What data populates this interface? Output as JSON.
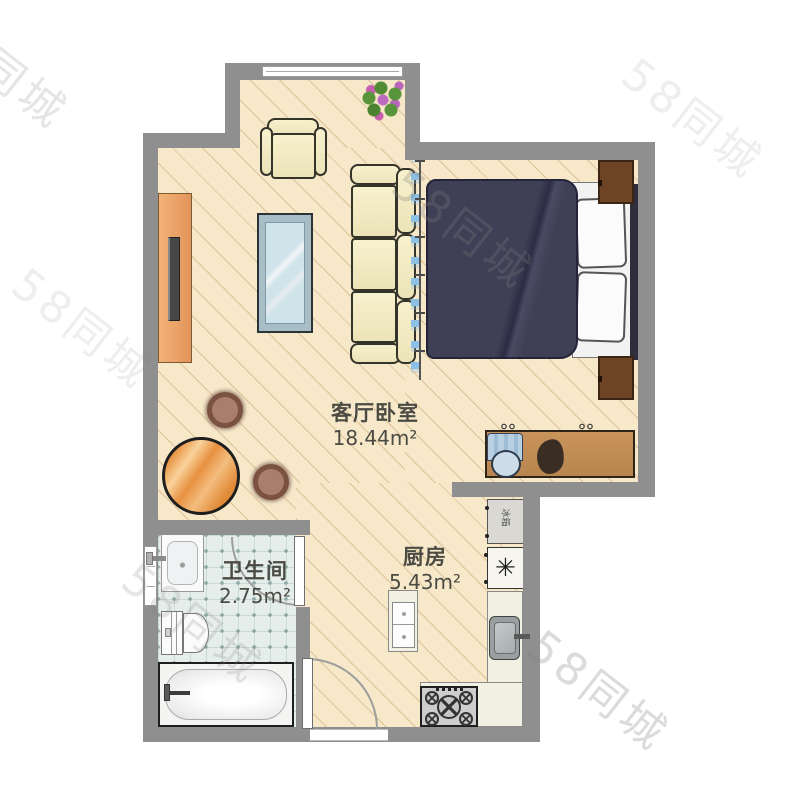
{
  "watermark": {
    "text": "58同城"
  },
  "rooms": {
    "living_bedroom": {
      "label": "客厅卧室",
      "area": "18.44m²"
    },
    "kitchen": {
      "label": "厨房",
      "area": "5.43m²"
    },
    "bathroom": {
      "label": "卫生间",
      "area": "2.75m²"
    }
  },
  "kitchen_items": {
    "fridge_label": "冰箱",
    "water_heater_symbol": "✳"
  },
  "colors": {
    "floor": "#f6e8c9",
    "wall": "#8f8f8f",
    "tile": "#e6eeec",
    "bed_duvet": "#3f3f55",
    "wood": "#e9a566",
    "sofa": "#f6f0cc",
    "curtain": "#8cc0e4"
  }
}
